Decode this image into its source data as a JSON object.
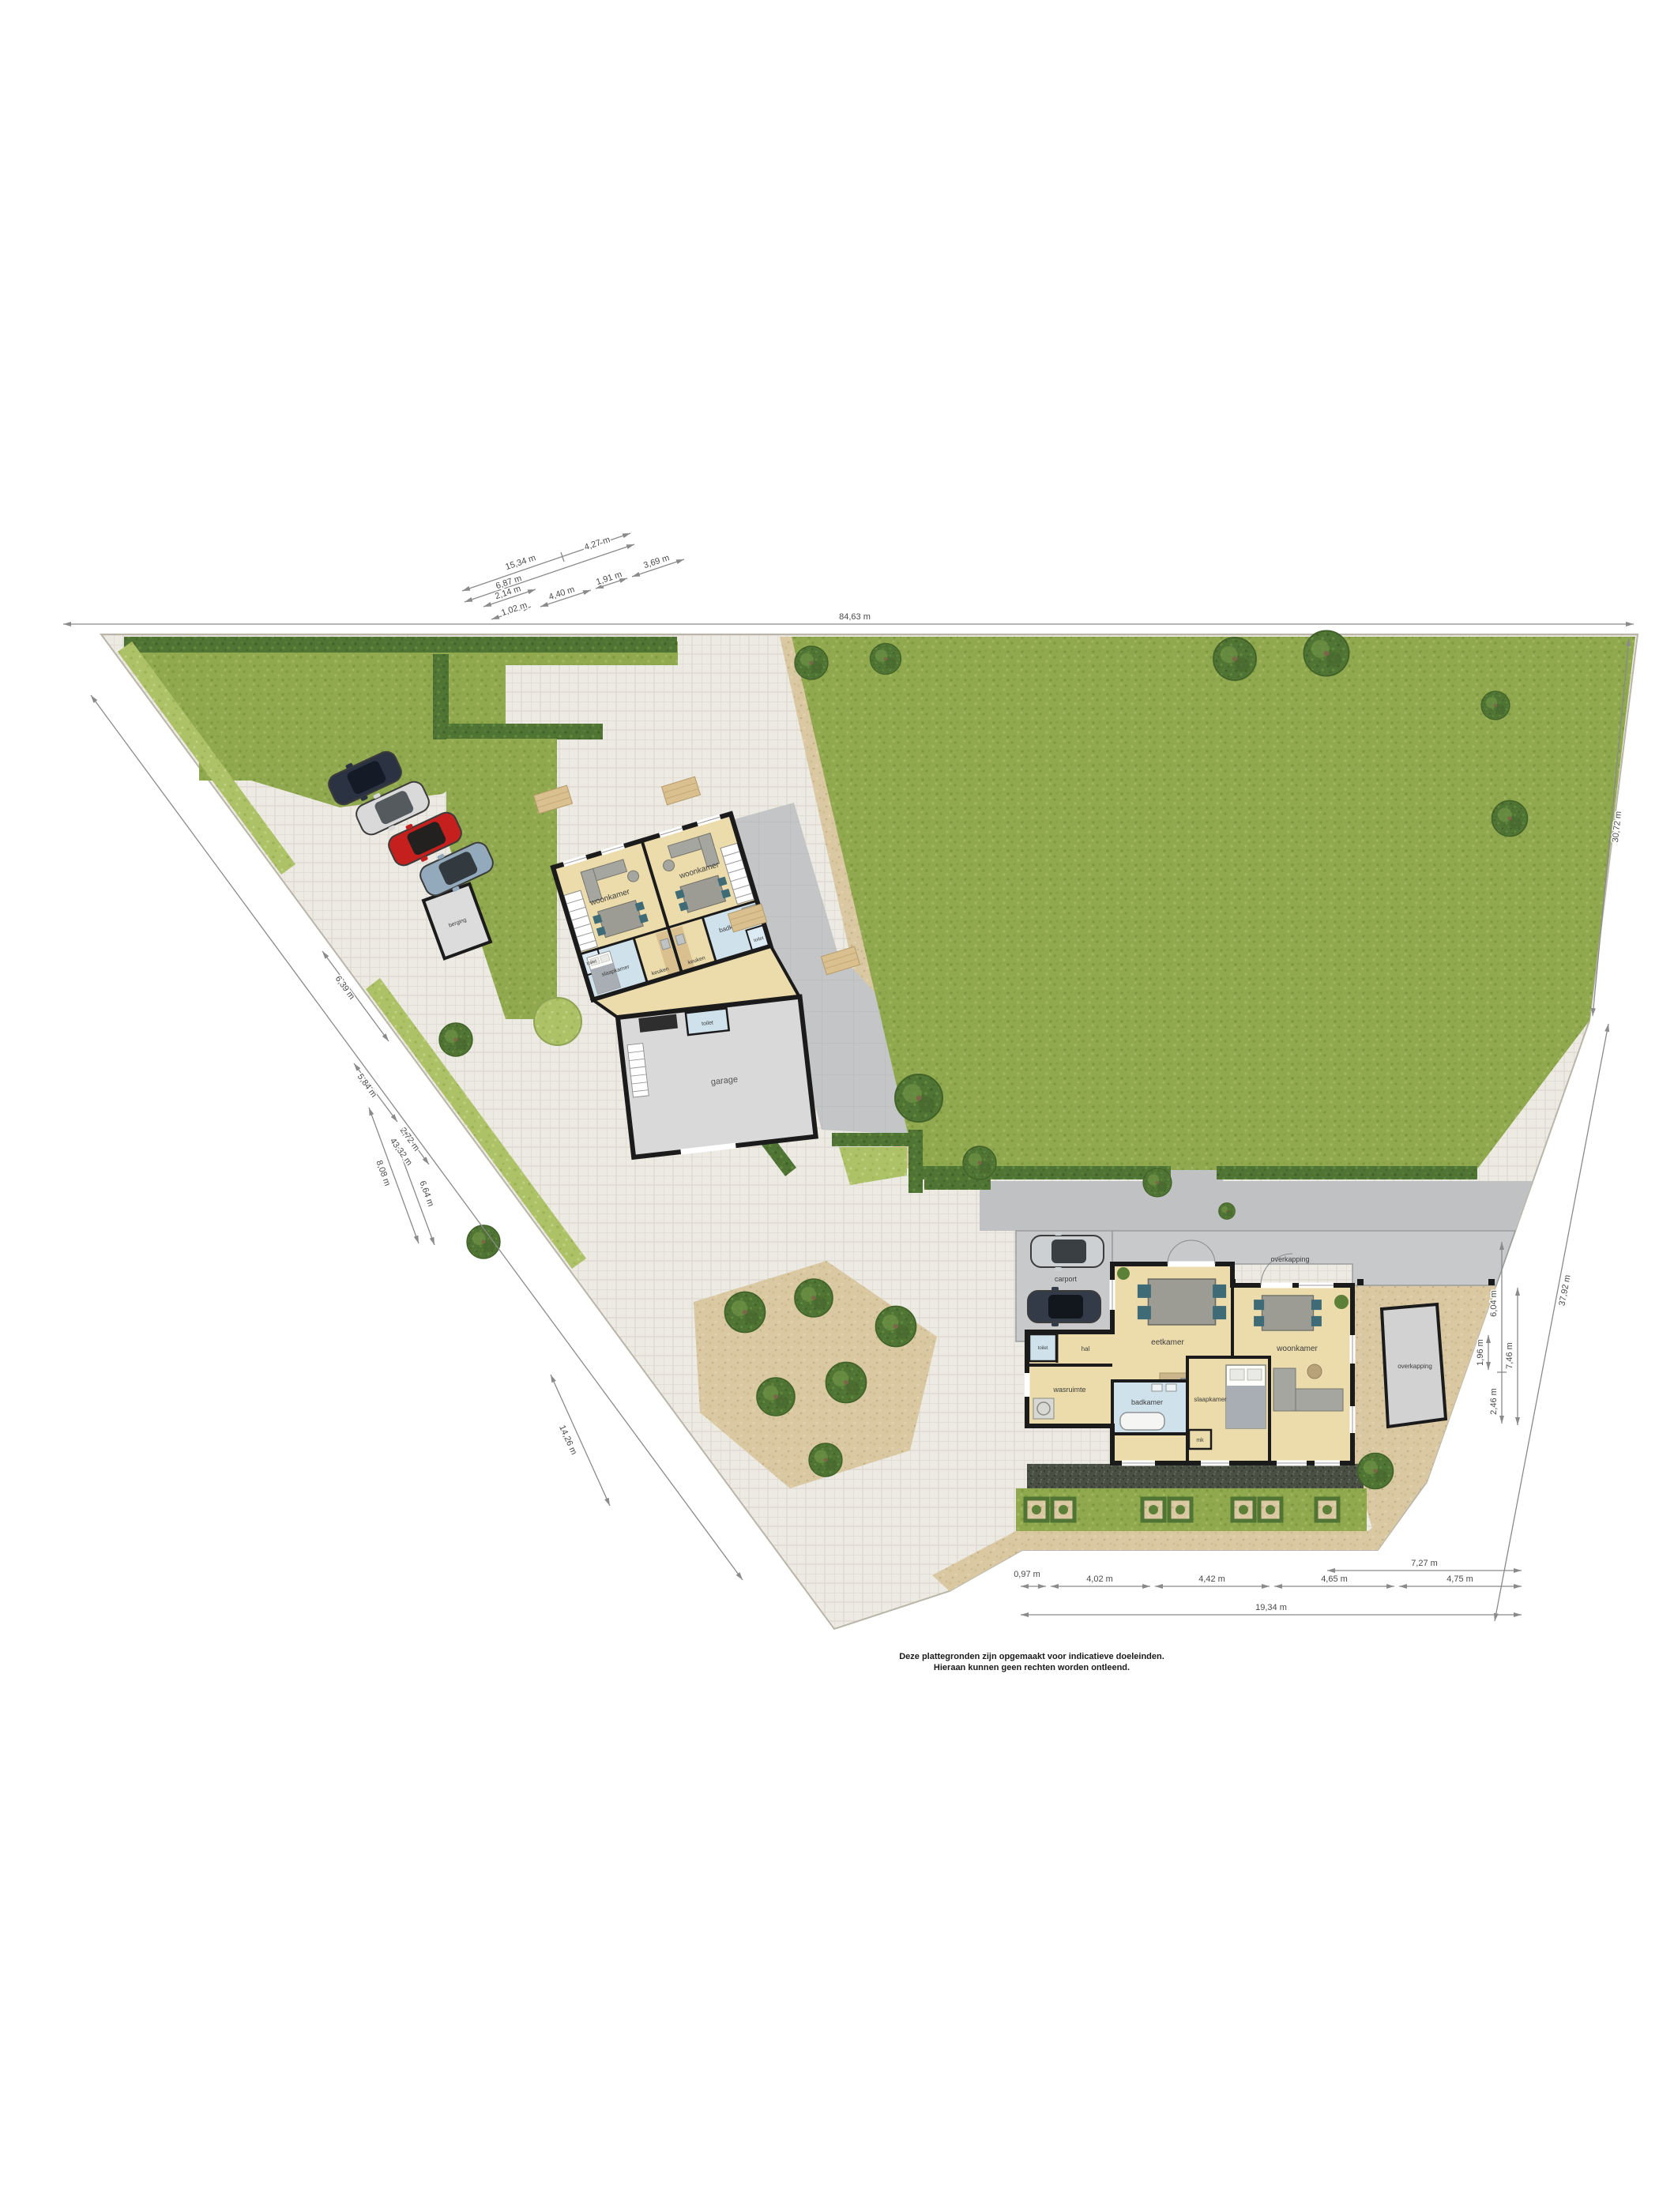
{
  "disclaimer": {
    "line1": "Deze plattegronden zijn opgemaakt voor indicatieve doeleinden.",
    "line2": "Hieraan kunnen geen rechten worden ontleend."
  },
  "colors": {
    "lawn": "#90a84e",
    "hedge": "#4f7433",
    "paving": "#eceae3",
    "room_floor": "#ecdcab",
    "wet_room": "#cfe2ec",
    "concrete": "#c3c5c7",
    "sand": "#d9c8a2",
    "wall": "#1b1b1b",
    "car_red": "#c5201d",
    "car_navy": "#2b3342"
  },
  "upper_building": {
    "unit_left": {
      "living": "woonkamer",
      "bedroom": "slaapkamer",
      "kitchen": "keuken",
      "toilet": "toilet"
    },
    "unit_right": {
      "living": "woonkamer",
      "kitchen": "keuken",
      "bathroom": "badkamer",
      "toilet": "toilet"
    },
    "garage": {
      "name": "garage",
      "toilet": "toilet"
    }
  },
  "outbuildings": {
    "shed": "berging",
    "canopy_right": "overkapping"
  },
  "lower_building": {
    "dining": "eetkamer",
    "living": "woonkamer",
    "bedroom": "slaapkamer",
    "bathroom": "badkamer",
    "laundry": "wasruimte",
    "hall": "hal",
    "closet": "mk",
    "toilet": "toilet",
    "carport": "carport",
    "canopy": "overkapping"
  },
  "dimensions": {
    "site_width": "84,63 m",
    "top": [
      "15,34 m",
      "4,27 m",
      "6,87 m",
      "2,14 m",
      "1,02 m",
      "4,40 m",
      "1,91 m",
      "3,69 m"
    ],
    "left": [
      "6,39 m",
      "5,84 m",
      "2,72 m",
      "8,08 m",
      "6,64 m",
      "43,32 m",
      "14,26 m"
    ],
    "right": [
      "30,72 m",
      "37,92 m",
      "6,04 m",
      "1,96 m",
      "2,46 m",
      "7,46 m"
    ],
    "bottom": [
      "0,97 m",
      "4,02 m",
      "4,42 m",
      "4,65 m",
      "4,75 m",
      "7,27 m",
      "19,34 m"
    ]
  }
}
